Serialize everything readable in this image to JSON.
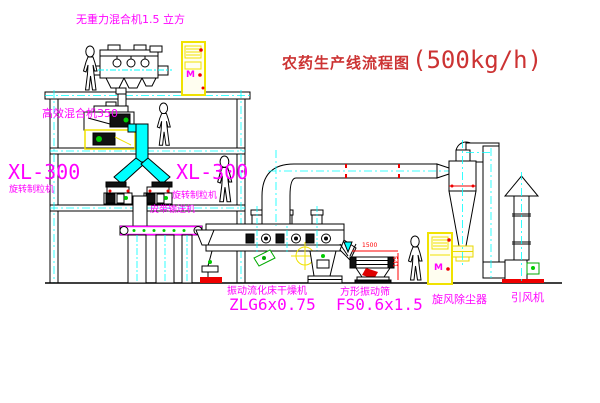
{
  "title": {
    "name": "农药生产线流程图",
    "capacity": "(500kg/h)"
  },
  "labels": {
    "gravity_mixer": "无重力混合机1.5 立方",
    "high_eff_mixer": "高效混合机350",
    "granulator_left": {
      "model": "XL-300",
      "name": "旋转制粒机"
    },
    "granulator_right": {
      "model": "XL-300",
      "name": "旋转制粒机"
    },
    "belt_conveyor": "皮带输送机",
    "fluid_bed_dryer": {
      "name": "振动流化床干燥机",
      "model": "ZLG6x0.75"
    },
    "vibrating_screen": {
      "name": "方形振动筛",
      "model": "FS0.6x1.5"
    },
    "cyclone": "旋风除尘器",
    "induced_draft_fan": "引风机"
  },
  "dimensions": {
    "screen_length": "1500",
    "screen_height": "541"
  },
  "cabinet_marks": {
    "cabinet1": "M",
    "cabinet2": "M"
  },
  "colors": {
    "label": "#ff00ff",
    "title": "#cc3333",
    "dimension": "#ff0000",
    "cabinet": "#f0e200",
    "pipe": "#00ffff",
    "motor_green": "#00aa00",
    "line": "#000000",
    "background": "#ffffff"
  }
}
